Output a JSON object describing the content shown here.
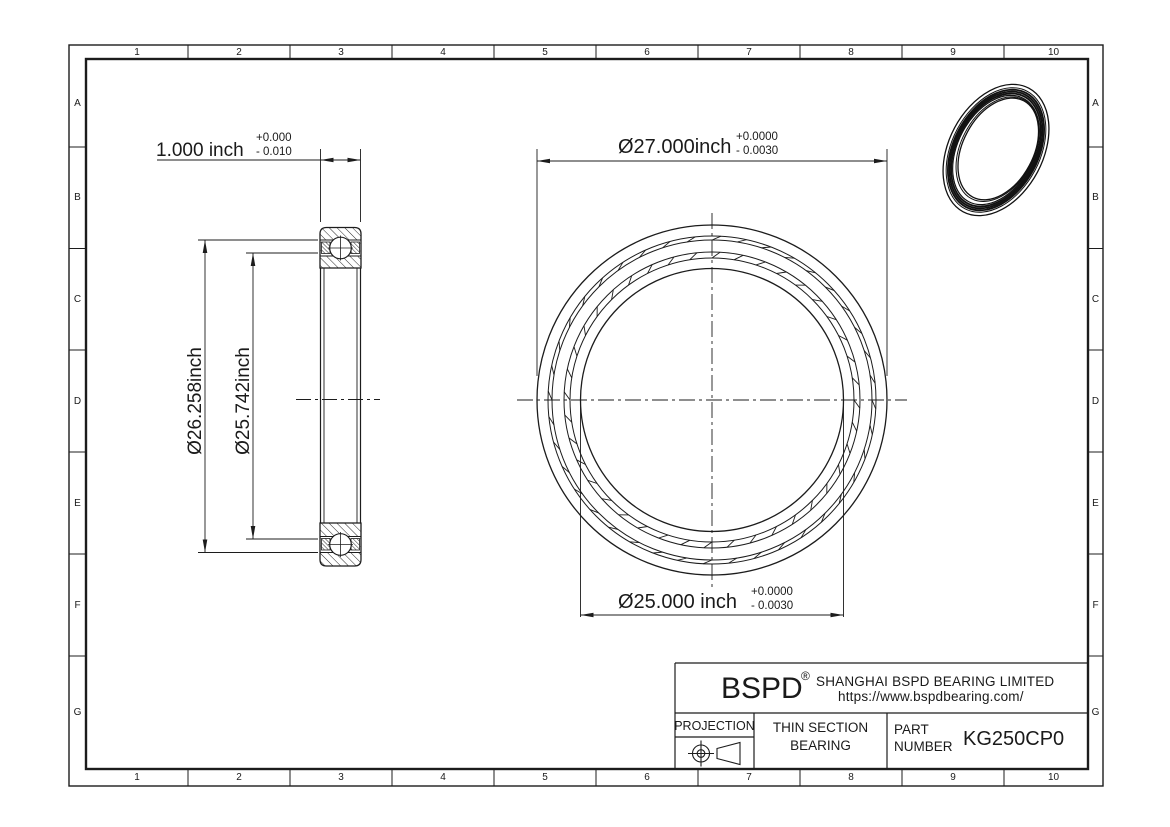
{
  "grid": {
    "columns": [
      "1",
      "2",
      "3",
      "4",
      "5",
      "6",
      "7",
      "8",
      "9",
      "10"
    ],
    "rows": [
      "A",
      "B",
      "C",
      "D",
      "E",
      "F",
      "G"
    ]
  },
  "dimensions": {
    "width": {
      "value": "1.000 inch",
      "tol_plus": "+0.000",
      "tol_minus": "- 0.010"
    },
    "outer_diameter": {
      "value": "Ø27.000inch",
      "tol_plus": "+0.0000",
      "tol_minus": "- 0.0030"
    },
    "outer_raceway": {
      "value": "Ø26.258inch"
    },
    "inner_raceway": {
      "value": "Ø25.742inch"
    },
    "bore": {
      "value": "Ø25.000 inch",
      "tol_plus": "+0.0000",
      "tol_minus": "- 0.0030"
    }
  },
  "title_block": {
    "logo": "BSPD",
    "registered": "®",
    "company": "SHANGHAI BSPD BEARING LIMITED",
    "website": "https://www.bspdbearing.com/",
    "projection_label": "PROJECTION",
    "product_type_line1": "THIN SECTION",
    "product_type_line2": "BEARING",
    "part_label_line1": "PART",
    "part_label_line2": "NUMBER",
    "part_number": "KG250CP0"
  },
  "colors": {
    "line": "#1c1c1c",
    "background": "#ffffff"
  }
}
